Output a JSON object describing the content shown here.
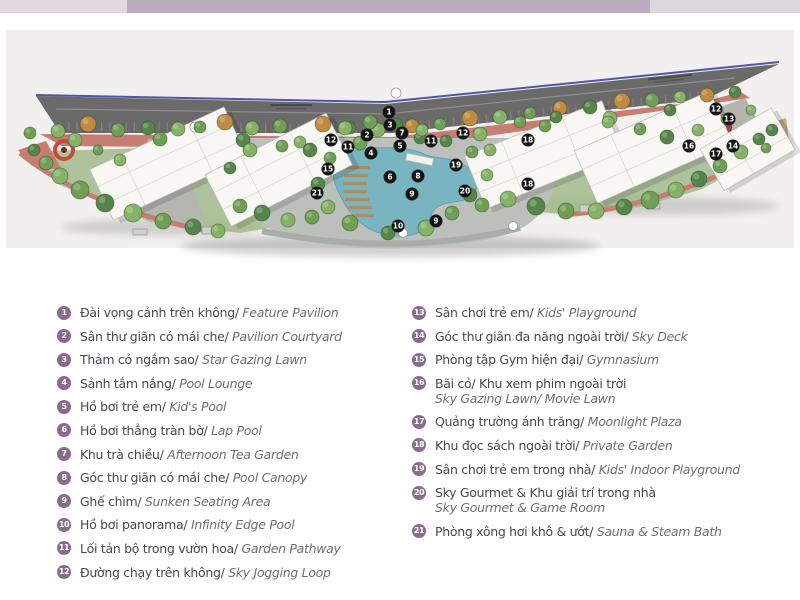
{
  "page": {
    "background": "#ffffff"
  },
  "top_bar": {
    "colors": {
      "left": "#e1d8e1",
      "center": "#bcaabf",
      "right": "#ded6de"
    }
  },
  "map": {
    "background": "#f1f0ee",
    "colors": {
      "road": "#6a6a6a",
      "road_fence_blue": "#4d57a5",
      "track_pink": "#c87d72",
      "pool_teal": "#79b4c1",
      "deck_gray": "#bcc0bb",
      "building_white": "#f8f7f4",
      "grass_green": "#9db886",
      "marker_bg": "#141414",
      "marker_text": "#ffffff",
      "red_feature": "#c84b3a"
    },
    "markers": [
      {
        "n": "1",
        "x": 389,
        "y": 112
      },
      {
        "n": "3",
        "x": 390,
        "y": 125
      },
      {
        "n": "7",
        "x": 402,
        "y": 133
      },
      {
        "n": "2",
        "x": 367,
        "y": 135
      },
      {
        "n": "5",
        "x": 400,
        "y": 146
      },
      {
        "n": "4",
        "x": 371,
        "y": 153
      },
      {
        "n": "11",
        "x": 348,
        "y": 147
      },
      {
        "n": "11",
        "x": 431,
        "y": 141
      },
      {
        "n": "12",
        "x": 331,
        "y": 140
      },
      {
        "n": "12",
        "x": 463,
        "y": 133
      },
      {
        "n": "12",
        "x": 716,
        "y": 109
      },
      {
        "n": "13",
        "x": 729,
        "y": 119
      },
      {
        "n": "14",
        "x": 733,
        "y": 146
      },
      {
        "n": "15",
        "x": 328,
        "y": 169
      },
      {
        "n": "16",
        "x": 689,
        "y": 146
      },
      {
        "n": "17",
        "x": 716,
        "y": 154
      },
      {
        "n": "18",
        "x": 528,
        "y": 140
      },
      {
        "n": "18",
        "x": 528,
        "y": 184
      },
      {
        "n": "19",
        "x": 456,
        "y": 165
      },
      {
        "n": "20",
        "x": 465,
        "y": 191
      },
      {
        "n": "21",
        "x": 317,
        "y": 193
      },
      {
        "n": "6",
        "x": 390,
        "y": 177
      },
      {
        "n": "8",
        "x": 418,
        "y": 176
      },
      {
        "n": "9",
        "x": 412,
        "y": 194
      },
      {
        "n": "9",
        "x": 436,
        "y": 221
      },
      {
        "n": "10",
        "x": 398,
        "y": 226
      }
    ]
  },
  "legend": {
    "marker_color": "#8a6b8f",
    "text_color": "#4b4453",
    "italic_color": "#716a76",
    "columns": [
      {
        "items": [
          {
            "num": "1",
            "vi": "Đài vọng cảnh trên không/",
            "en": "Feature Pavilion"
          },
          {
            "num": "2",
            "vi": "Sân thư giãn có mái che/",
            "en": "Pavilion Courtyard"
          },
          {
            "num": "3",
            "vi": "Thảm cỏ ngắm sao/",
            "en": "Star Gazing Lawn"
          },
          {
            "num": "4",
            "vi": "Sảnh tắm nắng/",
            "en": "Pool Lounge"
          },
          {
            "num": "5",
            "vi": "Hồ bơi trẻ em/",
            "en": "Kid's Pool"
          },
          {
            "num": "6",
            "vi": "Hồ bơi thẳng tràn bờ/",
            "en": "Lap Pool"
          },
          {
            "num": "7",
            "vi": "Khu trà chiều/",
            "en": "Afternoon Tea Garden"
          },
          {
            "num": "8",
            "vi": "Góc thư giãn có mái che/",
            "en": "Pool Canopy"
          },
          {
            "num": "9",
            "vi": "Ghế chìm/",
            "en": "Sunken Seating Area"
          },
          {
            "num": "10",
            "vi": "Hồ bơi panorama/",
            "en": "Infinity Edge Pool"
          },
          {
            "num": "11",
            "vi": "Lối tản bộ trong vườn hoa/",
            "en": "Garden Pathway"
          },
          {
            "num": "12",
            "vi": "Đường chạy trên không/",
            "en": "Sky Jogging Loop"
          }
        ]
      },
      {
        "items": [
          {
            "num": "13",
            "vi": "Sân chơi trẻ em/",
            "en": "Kids' Playground"
          },
          {
            "num": "14",
            "vi": "Góc thư giãn đa năng ngoài trời/",
            "en": "Sky Deck"
          },
          {
            "num": "15",
            "vi": "Phòng tập Gym hiện đại/",
            "en": "Gymnasium"
          },
          {
            "num": "16",
            "vi": "Bãi cỏ/ Khu xem phim ngoài trời",
            "en": "Sky Gazing Lawn/ Movie Lawn",
            "wrap": true
          },
          {
            "num": "17",
            "vi": "Quảng trường ánh trăng/",
            "en": "Moonlight Plaza"
          },
          {
            "num": "18",
            "vi": "Khu đọc sách ngoài trời/",
            "en": "Private Garden"
          },
          {
            "num": "19",
            "vi": "Sân chơi trẻ em trong nhà/",
            "en": "Kids' Indoor Playground"
          },
          {
            "num": "20",
            "vi": "Sky Gourmet & Khu giải trí trong nhà",
            "en": "Sky Gourmet & Game Room",
            "wrap": true
          },
          {
            "num": "21",
            "vi": "Phòng xông hơi khô & ướt/",
            "en": "Sauna & Steam Bath"
          }
        ]
      }
    ]
  }
}
